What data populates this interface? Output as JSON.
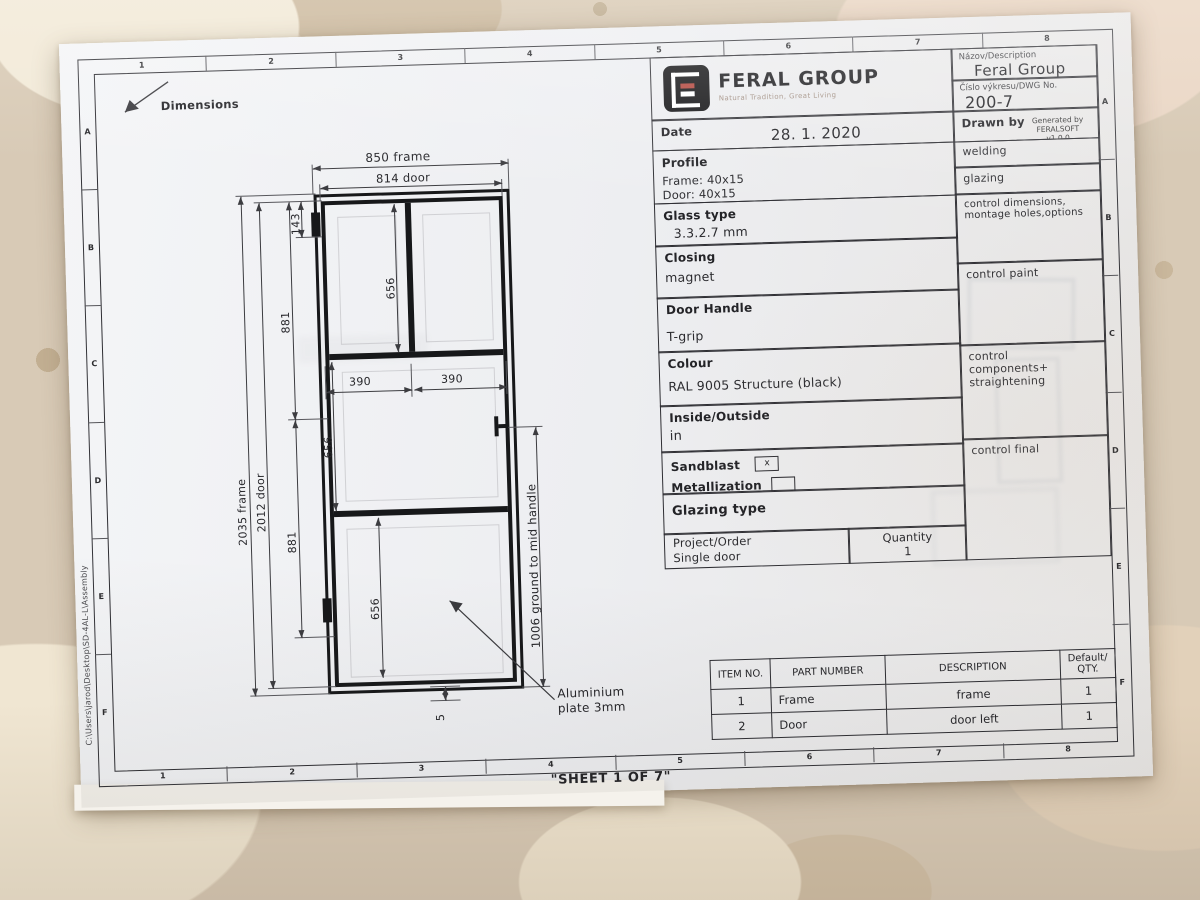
{
  "sheet": {
    "corner_label": "Dimensions",
    "sheet_note": "\"SHEET 1 OF 7\"",
    "file_path": "C:\\Users\\jarod\\Desktop\\SD-4AL-L\\Assembly",
    "zone_cols": [
      "1",
      "2",
      "3",
      "4",
      "5",
      "6",
      "7",
      "8"
    ],
    "zone_rows": [
      "A",
      "B",
      "C",
      "D",
      "E",
      "F"
    ]
  },
  "title_block": {
    "logo_text": "FERAL GROUP",
    "logo_tagline": "Natural Tradition, Great Living",
    "description_label": "Názov/Description",
    "description_value": "Feral Group",
    "dwg_label": "Číslo výkresu/DWG No.",
    "dwg_value": "200-7",
    "date_label": "Date",
    "date_value": "28. 1. 2020",
    "drawn_by_label": "Drawn by",
    "drawn_by_value": "Generated by FERALSOFT",
    "drawn_by_version": "v1.0.0",
    "specs": [
      {
        "label": "Profile",
        "lines": [
          "Frame: 40x15",
          "Door: 40x15"
        ]
      },
      {
        "label": "Glass type",
        "lines": [
          "3.3.2.7 mm",
          ""
        ]
      },
      {
        "label": "Closing",
        "lines": [
          "magnet",
          ""
        ]
      },
      {
        "label": "Door Handle",
        "lines": [
          "T-grip",
          ""
        ]
      },
      {
        "label": "Colour",
        "lines": [
          "RAL 9005 Structure (black)",
          ""
        ]
      },
      {
        "label": "Inside/Outside",
        "lines": [
          "in",
          ""
        ]
      }
    ],
    "sandblast_label": "Sandblast",
    "sandblast_mark": "x",
    "metallization_label": "Metallization",
    "metallization_mark": "",
    "glazing_type_label": "Glazing type",
    "project_label": "Project/Order",
    "project_value": "Single door",
    "quantity_label": "Quantity",
    "quantity_value": "1",
    "checks": [
      "welding",
      "glazing",
      "control dimensions, montage holes,options",
      "control paint",
      "control components+ straightening",
      "control final"
    ]
  },
  "parts_table": {
    "headers": [
      "ITEM NO.",
      "PART NUMBER",
      "DESCRIPTION",
      "Default/\nQTY."
    ],
    "rows": [
      [
        "1",
        "Frame",
        "frame",
        "1"
      ],
      [
        "2",
        "Door",
        "door left",
        "1"
      ]
    ]
  },
  "dims": {
    "frame_width": "850 frame",
    "door_width": "814 door",
    "frame_height": "2035 frame",
    "door_height": "2012 door",
    "top_offset": "143",
    "upper_span": "881",
    "upper_glass": "656",
    "pane_left": "390",
    "pane_right": "390",
    "mid_glass": "656",
    "lower_span": "881",
    "lower_glass": "656",
    "handle_note": "1006 ground to mid handle",
    "bottom_gap": "5",
    "plate_callout": "Aluminium\nplate 3mm"
  }
}
